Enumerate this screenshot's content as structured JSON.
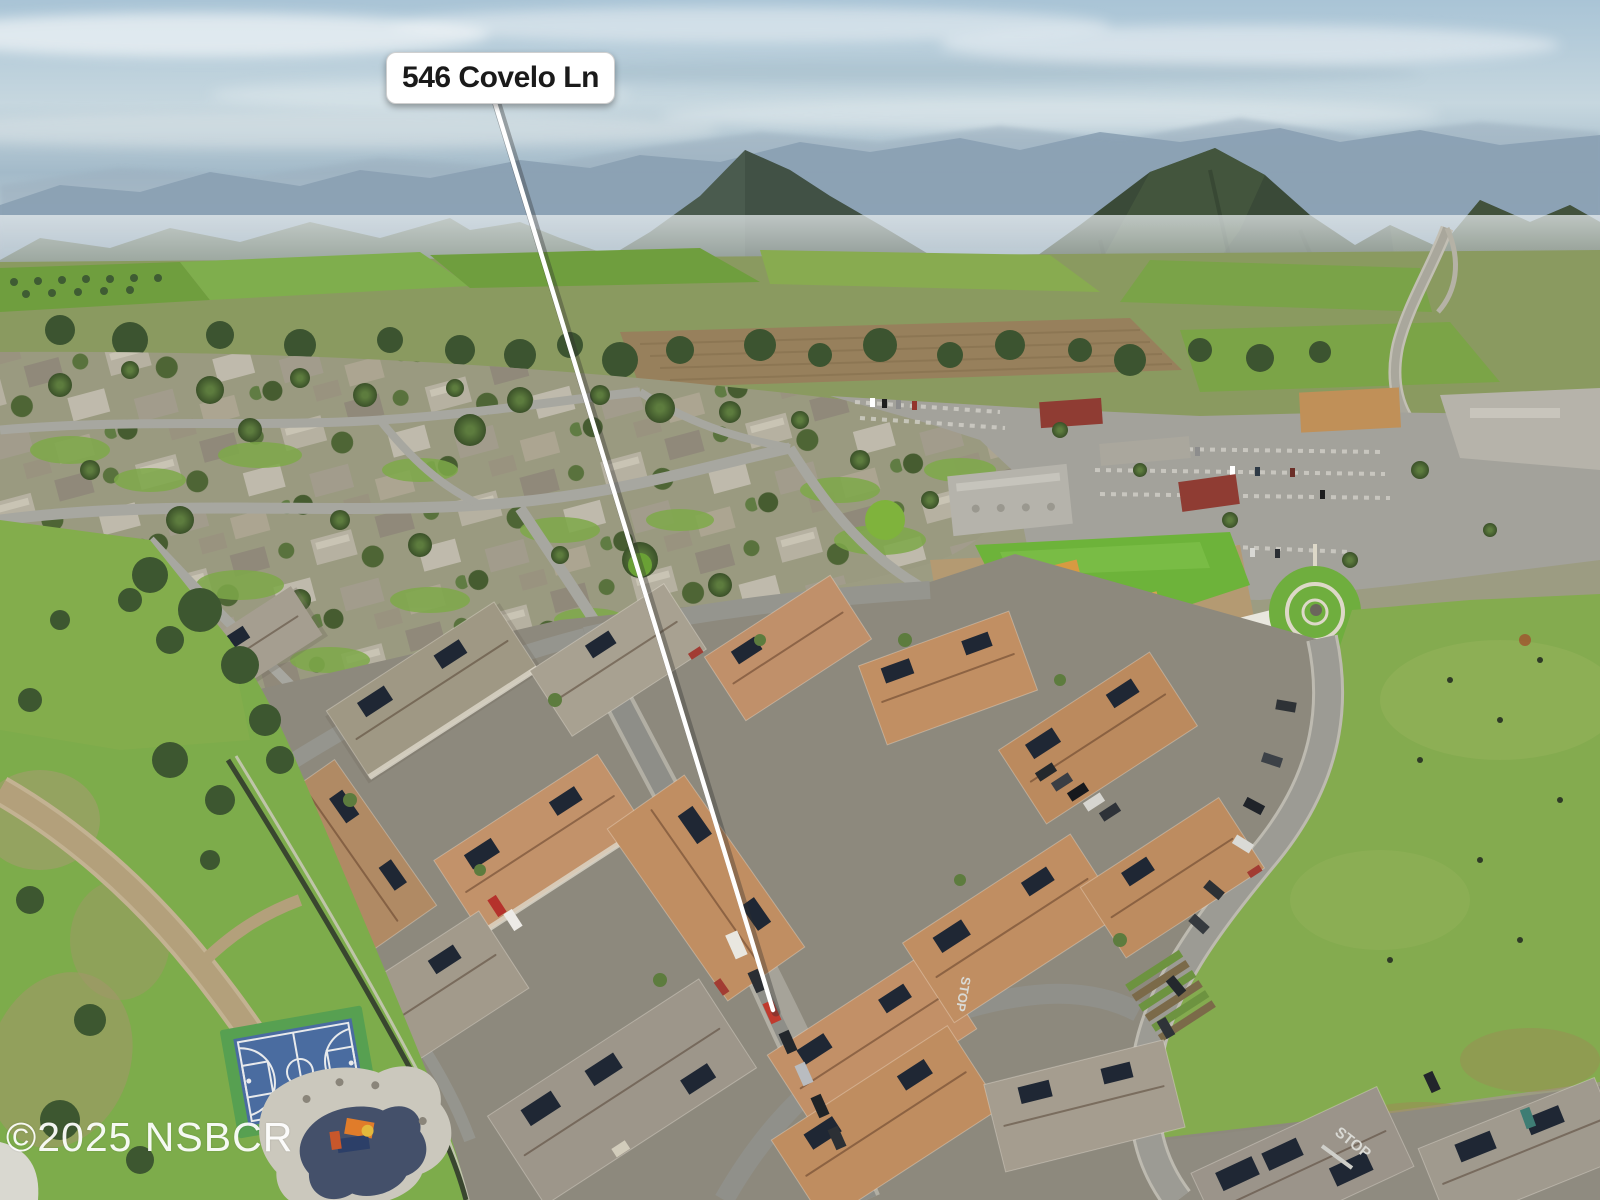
{
  "overlay": {
    "address_label": "546 Covelo Ln",
    "watermark": "©2025 NSBCR"
  },
  "road_markings": {
    "stop": "STOP"
  },
  "palette": {
    "sky_top": "#a9c4d6",
    "mountain_far": "#8aa0b2",
    "mountain_near": "#3a4a38",
    "valley_green": "#7fae4d",
    "town_base": "#9a9a80",
    "road_gray": "#9c9b94",
    "roof_terracotta": "#c08e62",
    "roof_gray": "#9d968a",
    "solar_panel": "#1f2734",
    "court_blue": "#4a6ca0",
    "court_green": "#57a051",
    "playground_rubber": "#44506a",
    "dirt_path": "#b3a07b",
    "field_green": "#84ab4f",
    "leader_line": "#ffffff",
    "label_background": "#ffffff",
    "label_text": "#1a1a1a",
    "watermark_color": "#ffffff",
    "stop_marking": "#d9d9d4"
  }
}
